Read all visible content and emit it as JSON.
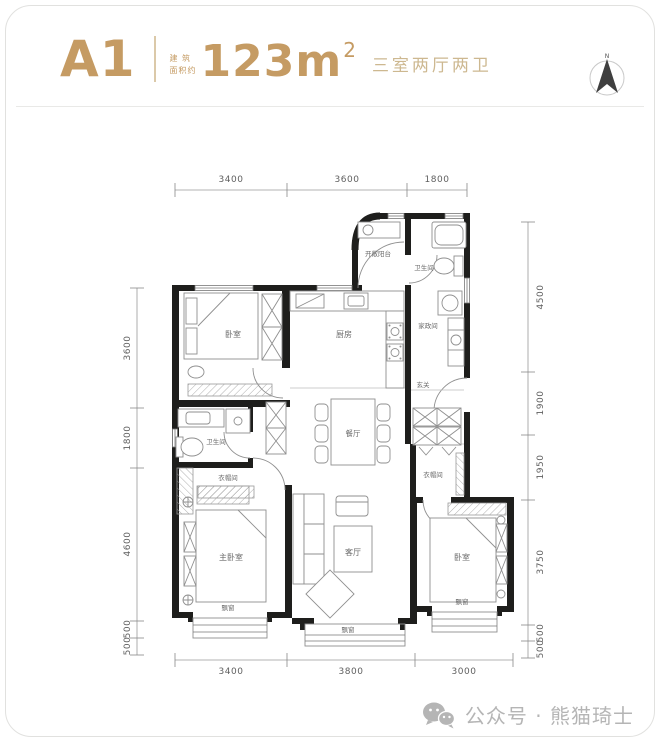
{
  "header": {
    "unit": "A1",
    "area_prefix_top": "建 筑",
    "area_prefix_bottom": "面积约",
    "area_value": "123m",
    "area_sup": "2",
    "layout_desc": "三室两厅两卫"
  },
  "compass": {
    "north_label": "N"
  },
  "plan": {
    "rooms": {
      "bedroom_top_left": "卧室",
      "kitchen": "厨房",
      "open_balcony": "开敞阳台",
      "bathroom_top": "卫生间",
      "utility_room": "家政间",
      "foyer": "玄关",
      "bathroom_left": "卫生间",
      "closet_left": "衣帽间",
      "dining_room": "餐厅",
      "closet_right": "衣帽间",
      "master_bedroom": "主卧室",
      "living_room": "客厅",
      "bedroom_bottom_right": "卧室",
      "bay_window_left": "飘窗",
      "bay_window_middle": "飘窗",
      "bay_window_right": "飘窗"
    },
    "dimensions": {
      "top": [
        "3400",
        "3600",
        "1800"
      ],
      "bottom": [
        "3400",
        "3800",
        "3000"
      ],
      "left": [
        "3600",
        "1800",
        "4600",
        "500",
        "500"
      ],
      "right": [
        "4500",
        "1900",
        "1950",
        "3750",
        "500",
        "500"
      ]
    }
  },
  "footer": {
    "watermark": "公众号 · 熊猫琦士"
  },
  "colors": {
    "gold": "#C59B63",
    "gold_light": "#CDB890",
    "wall": "#1e1e1c",
    "drawing_line": "#8f8f8f",
    "label_text": "#6b6b6b",
    "watermark_text": "#b5b5b5"
  }
}
